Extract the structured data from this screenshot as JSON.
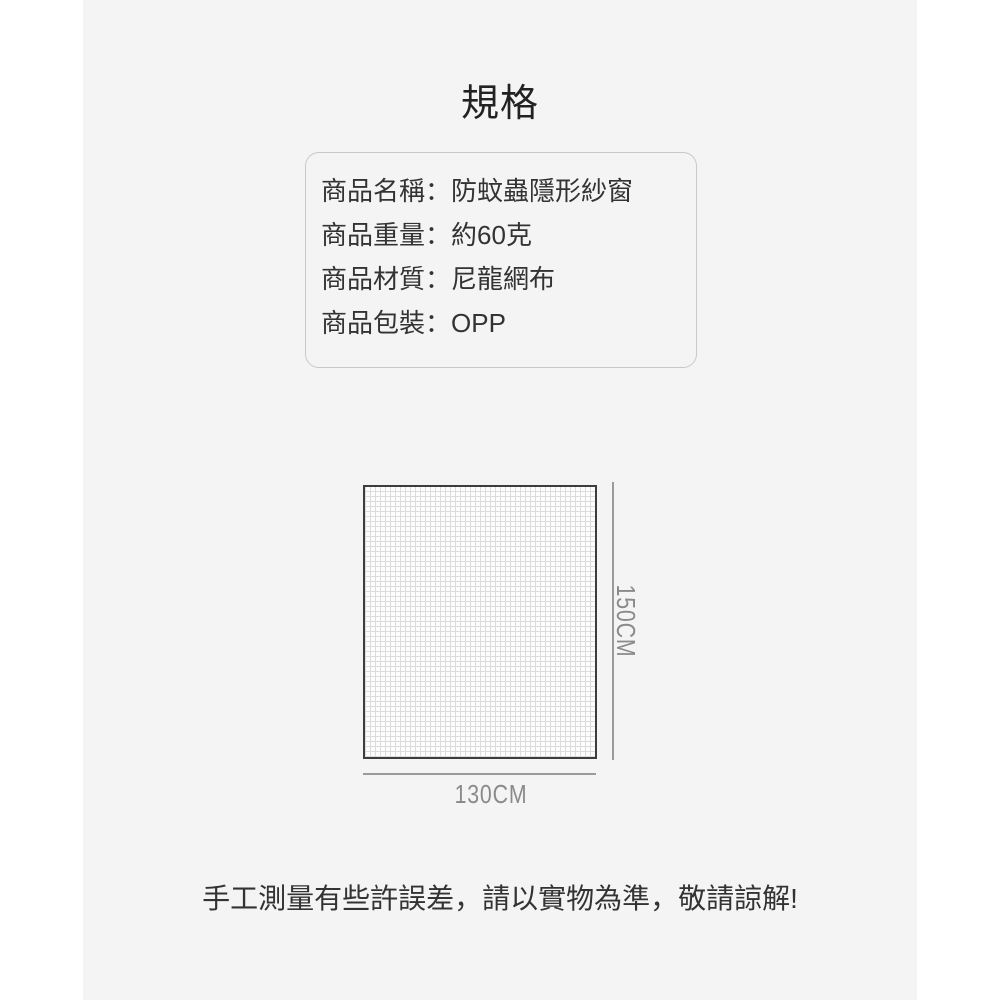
{
  "page": {
    "title": "規格",
    "note": "手工測量有些許誤差，請以實物為準，敬請諒解!",
    "colors": {
      "content_bg": "#f4f4f5",
      "outer_bg": "#ffffff",
      "text_primary": "#333333",
      "title_color": "#222222",
      "dim_color": "#8a8a8a",
      "dim_line": "#9b9b9b",
      "mesh_border": "#3d3d3d",
      "mesh_bg": "#fdfdfd",
      "mesh_grid": "#dcdcdc",
      "box_border": "#c8c8c8"
    }
  },
  "spec_box": {
    "colon": "：",
    "rows": [
      {
        "label": "商品名稱",
        "value": "防蚊蟲隱形紗窗"
      },
      {
        "label": "商品重量",
        "value": "約60克"
      },
      {
        "label": "商品材質",
        "value": "尼龍網布"
      },
      {
        "label": "商品包裝",
        "value": "OPP"
      }
    ]
  },
  "diagram": {
    "height_label": "150CM",
    "width_label": "130CM"
  }
}
